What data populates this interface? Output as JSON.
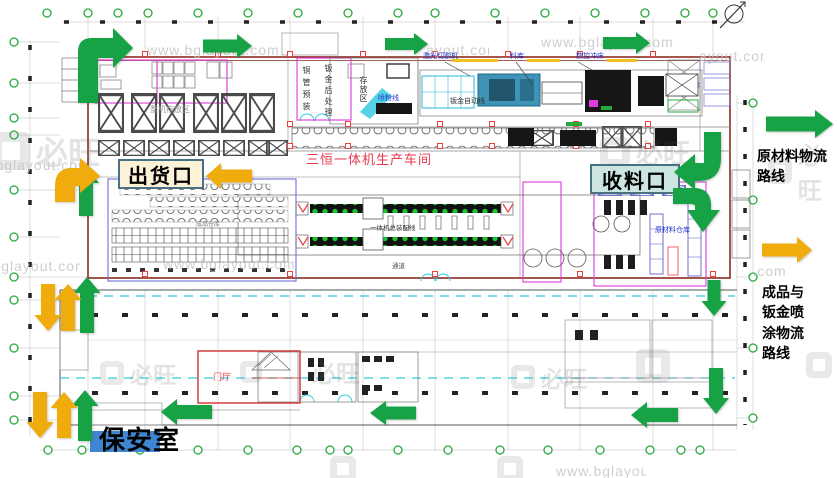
{
  "gates": {
    "shipping": {
      "label": "出货口",
      "bg": "#FBF2D8",
      "border": "#4A7086"
    },
    "receiving": {
      "label": "收料口",
      "bg": "#CBE6E0",
      "border": "#4A7086"
    },
    "security": {
      "label": "保安室",
      "highlight": "#3E86D1"
    }
  },
  "legend": {
    "raw_material": {
      "label": "原材料物流路线",
      "arrow_color": "#17A345"
    },
    "finished_goods": {
      "label": "成品与钣金喷涂物流路线",
      "arrow_color": "#F0AB0C"
    }
  },
  "flow_colors": {
    "green": "#17A345",
    "yellow": "#F0AB0C"
  },
  "plan_labels": {
    "workshop": "三恒一体机生产车间",
    "assembly_line": "一体机总装配线",
    "aisle": "通道",
    "lobby": "门厅",
    "copper_preassembly": "铜管预装",
    "sheetmetal_post": "钣金后处理",
    "storage_area": "存放区",
    "sheetmetal_auto_line": "钣金自动线",
    "laser_cutter": "激光切割机",
    "material_store": "料库",
    "cnc_punch": "数控冲床",
    "raw_material_warehouse": "原材料仓库",
    "finished_warehouse": "成品仓库",
    "unit_storage": "整机存放区",
    "powder_line": "喷粉线"
  },
  "watermark": {
    "brand": "必旺",
    "url": "www.bglayout.com"
  },
  "colors": {
    "wall": "#8D2B21",
    "partition_magenta": "#DD3DDD",
    "rack_blue": "#6F6FD8",
    "cad_cyan": "#35CBDE",
    "column_red": "#E84040",
    "label_red": "#E8374A",
    "machine_label_blue": "#2233CC",
    "grid_bubble_green": "#27A93C"
  }
}
